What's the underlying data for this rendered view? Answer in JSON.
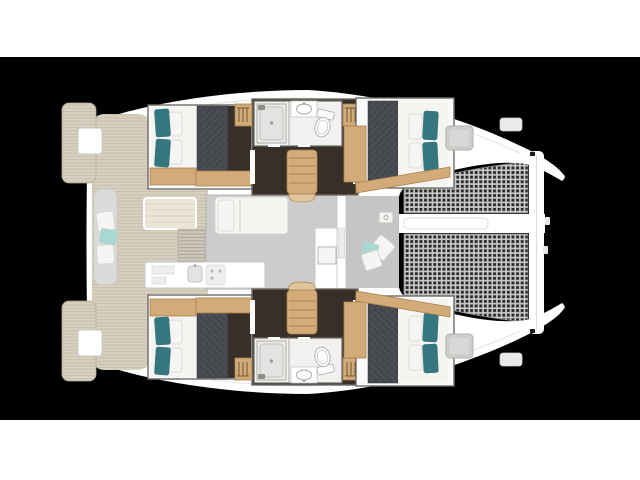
{
  "meta": {
    "vessel": "catamaran",
    "view": "overhead-deck-floor-plan",
    "bow_direction": "right",
    "cabin_count": 4,
    "bathroom_count": 2,
    "trampoline_count": 2
  },
  "palette": {
    "page_band": "#ffffff",
    "backdrop": "#000000",
    "hull": "#ffffff",
    "teak": "#d7cfc0",
    "teak_line": "#b6ab94",
    "teak_pale": "#ece5d6",
    "wood": "#d2ab79",
    "wood_light": "#dfc49c",
    "wood_line": "#a9834f",
    "dark_floor": "#372f28",
    "duvet": "#43464b",
    "duvet_hi": "#585b61",
    "mattress": "#f5f4f1",
    "teal": "#35767f",
    "aqua": "#a9d8d2",
    "saloon_floor": "#cdccca",
    "foredeck_floor": "#c6c5c3",
    "bench": "#dcdbd9",
    "frame": "#6e6c66",
    "bath_floor": "#f2f1ef",
    "fixture": "#e4e3e1",
    "fixture_line": "#a6a5a1",
    "net_hole": "#2a2a28",
    "net_cord": "#c9c9c9",
    "hatch": "#cfcecc",
    "soft_line": "#c9c8c6"
  },
  "areas": [
    "swim-platform-port",
    "swim-platform-starboard",
    "aft-cockpit",
    "cockpit-bench",
    "cockpit-table",
    "saloon",
    "saloon-lounge",
    "galley",
    "galley-island",
    "companionway-steps-port",
    "companionway-steps-starboard",
    "aft-cabin-port",
    "aft-cabin-starboard",
    "forward-cabin-port",
    "forward-cabin-starboard",
    "bathroom-port",
    "bathroom-starboard",
    "foredeck-lounge",
    "trampoline-port",
    "trampoline-starboard",
    "forward-crossbeam",
    "center-walkway-beam"
  ]
}
